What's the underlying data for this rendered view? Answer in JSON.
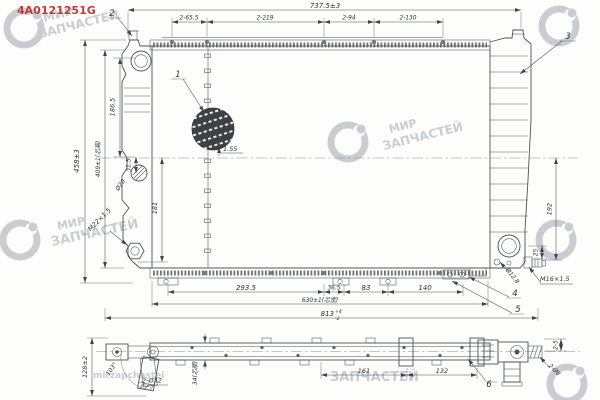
{
  "part_number": "4A0121251G",
  "watermark": {
    "mir": "МИР",
    "zapchastei": "ЗАПЧАСТЕЙ",
    "latin": "mirzapchastei"
  },
  "front": {
    "top": {
      "overall": "737.5±3",
      "seg1": "2-65.5",
      "seg2": "2-219",
      "seg3": "2-94",
      "seg4": "2-130"
    },
    "left": {
      "overall": "458±3",
      "core_height": "409±1(芯高)",
      "upper": "186.5",
      "offset": "31.5",
      "port": "Ø20",
      "lower": "181",
      "drain_thread": "M22×1.5"
    },
    "right": {
      "outlet_drop": "192",
      "fitting_offset": "25",
      "fitting_thread": "M16×1.5",
      "pipe": "Ø12.8"
    },
    "bottom": {
      "seg1": "293.5",
      "seg2": "36.5",
      "seg3": "83",
      "seg4": "140",
      "core_width": "630±1(芯宽)",
      "overall": "813",
      "tol_up": "+4",
      "tol_dn": "-2"
    },
    "detail": {
      "fin_pitch": "1.55"
    }
  },
  "side": {
    "height": "128±2",
    "pipe_angle": "103°",
    "pipes": "2-Ø32",
    "core_thick": "34(芯厚)",
    "seg1": "161",
    "seg2": "132",
    "end_slots": "2-5",
    "end_holes": "2-Ø8"
  },
  "callouts": {
    "c1": "1",
    "c2": "2",
    "c3": "3",
    "c4": "4",
    "c5": "5",
    "c6": "6"
  }
}
